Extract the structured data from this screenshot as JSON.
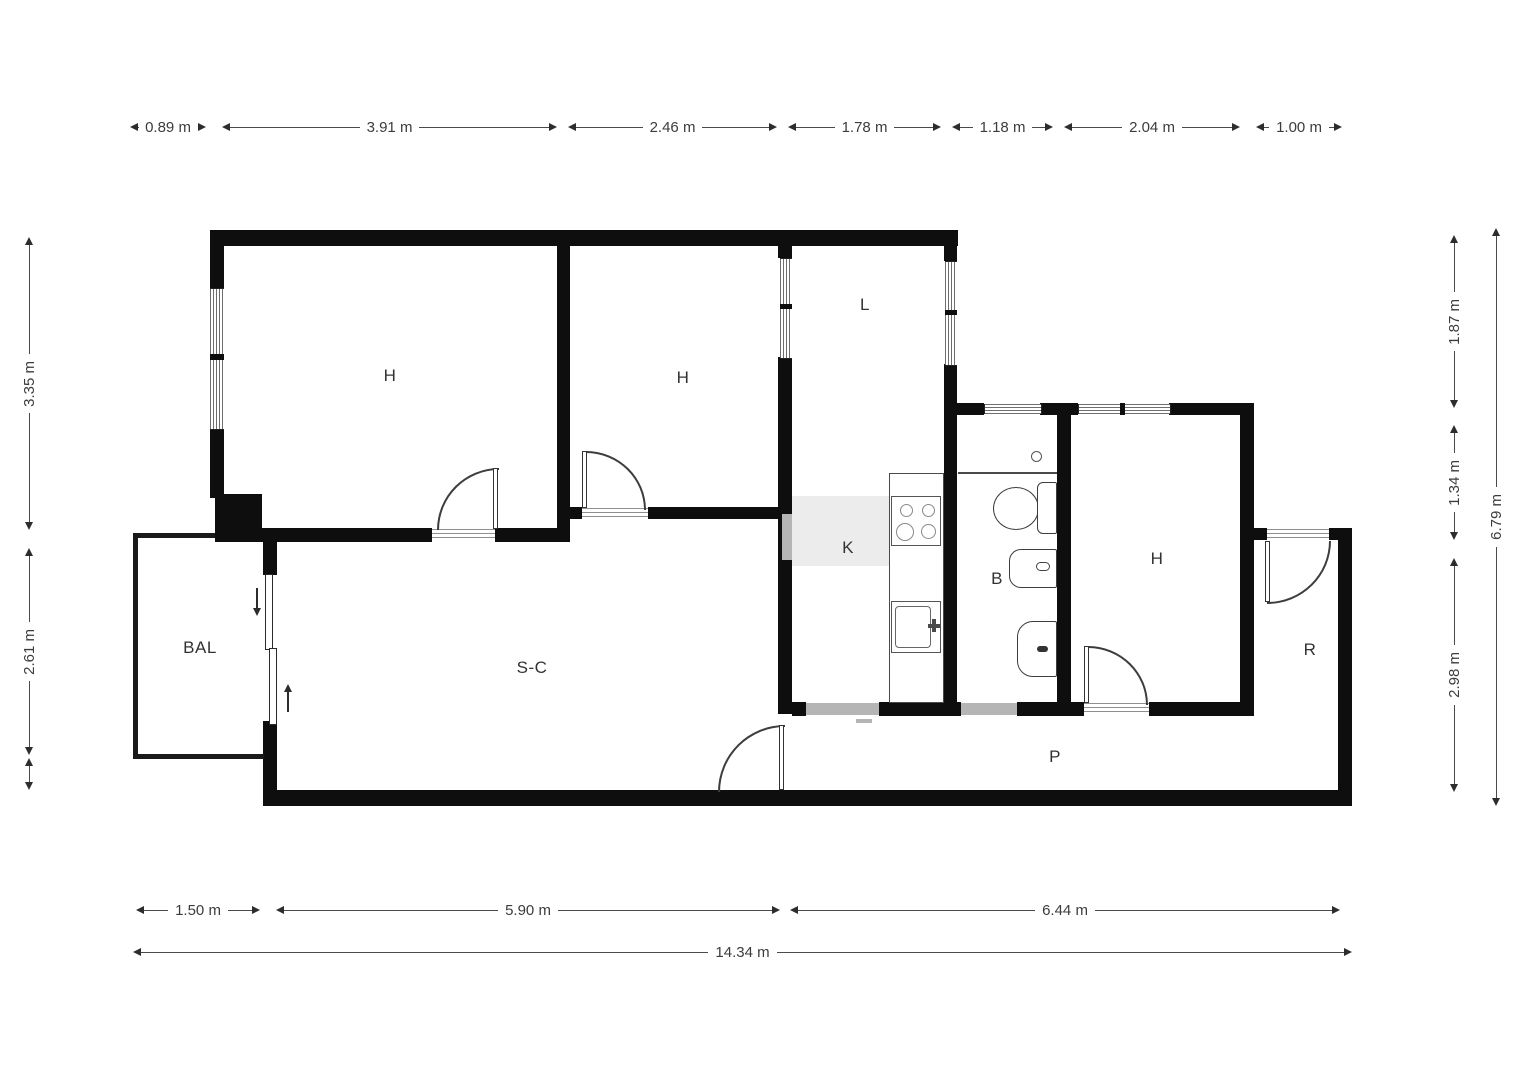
{
  "floorplan": {
    "rooms": [
      {
        "key": "bedroom-1",
        "label": "H"
      },
      {
        "key": "bedroom-2",
        "label": "H"
      },
      {
        "key": "gallery",
        "label": "L"
      },
      {
        "key": "kitchen",
        "label": "K"
      },
      {
        "key": "bathroom",
        "label": "B"
      },
      {
        "key": "bedroom-3",
        "label": "H"
      },
      {
        "key": "balcony",
        "label": "BAL"
      },
      {
        "key": "living-dining",
        "label": "S-C"
      },
      {
        "key": "entry-hall",
        "label": "R"
      },
      {
        "key": "corridor",
        "label": "P"
      }
    ],
    "dimensions_top": [
      "0.89 m",
      "3.91 m",
      "2.46 m",
      "1.78 m",
      "1.18 m",
      "2.04 m",
      "1.00 m"
    ],
    "dimensions_bottom": [
      "1.50 m",
      "5.90 m",
      "6.44 m"
    ],
    "dimension_bottom_total": "14.34 m",
    "dimensions_left": [
      "3.35 m",
      "2.61 m"
    ],
    "dimensions_right": [
      "1.87 m",
      "1.34 m",
      "2.98 m"
    ],
    "dimension_right_total": "6.79 m",
    "fixtures": [
      "stove",
      "kitchen-sink",
      "toilet",
      "bidet",
      "washbasin",
      "shower-drain",
      "sliding-balcony-door"
    ],
    "colors": {
      "wall": "#0e0e0e",
      "dimension_text": "#3c3c3c",
      "threshold_gray": "#b5b5b5",
      "fixture_stroke": "#3d3d3d",
      "background": "#ffffff"
    }
  }
}
